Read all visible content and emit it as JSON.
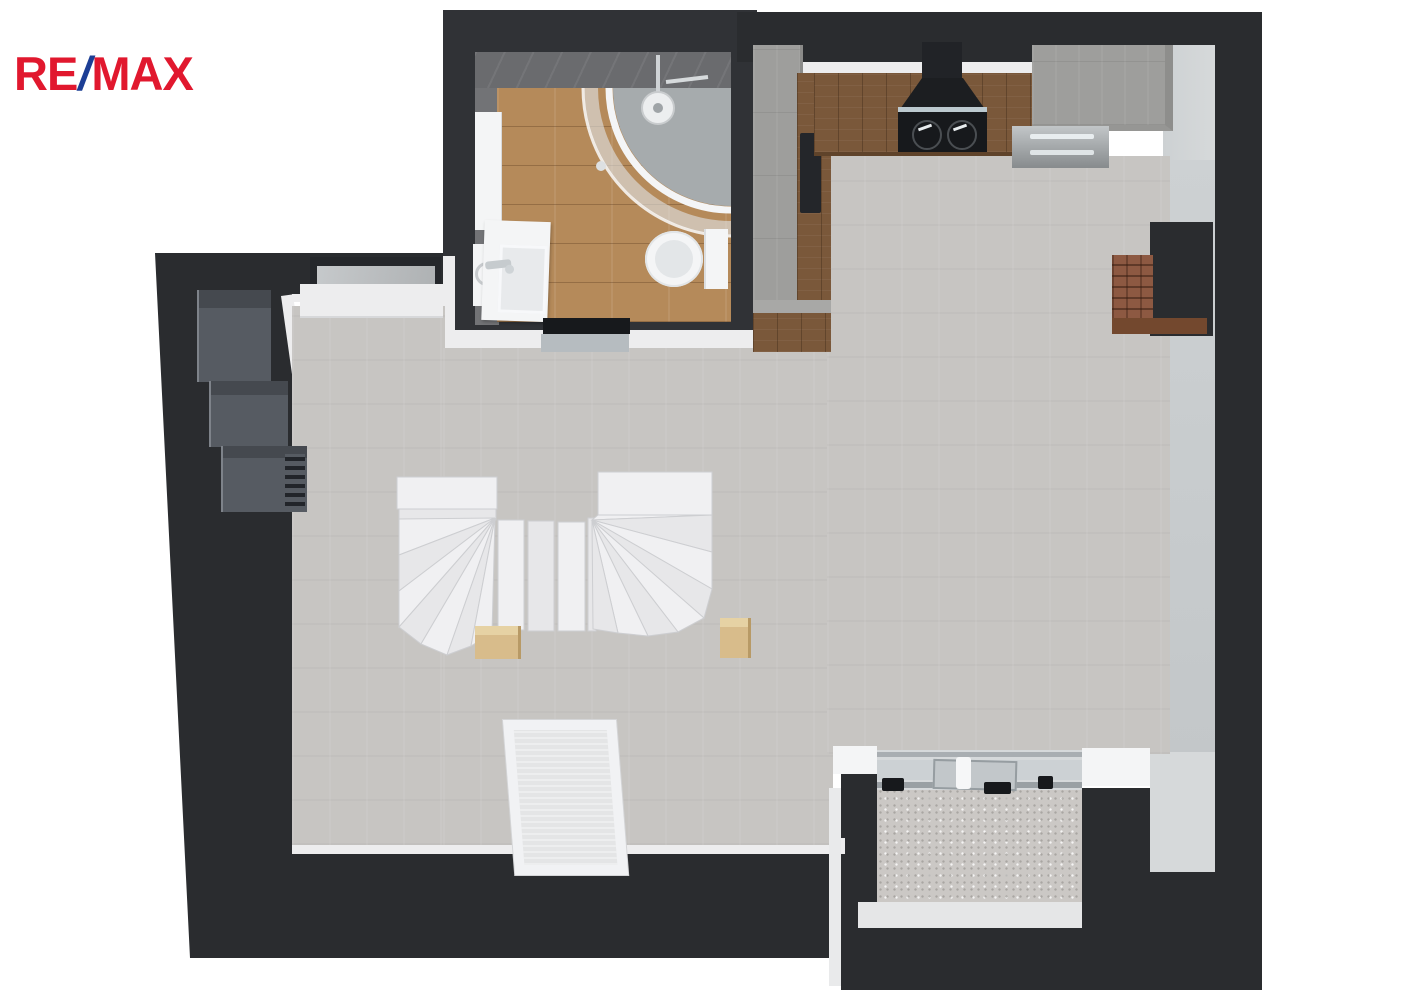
{
  "logo": {
    "re": "RE",
    "slash": "/",
    "max": "MAX"
  },
  "palette": {
    "wall": "#2a2c2f",
    "wallDeep": "#303236",
    "floor": "#c7c5c2",
    "trim": "#ededee",
    "tile": "#6a6b6e",
    "tileSide": "#727376",
    "woodFloor": "#b58a5a",
    "woodCounter": "#7a583a",
    "concrete": "#9e9e9c",
    "stairs": "#f0f0f2",
    "stairsShade": "#e7e7e9",
    "stairsLine": "#cdced1",
    "post": "#d8bc8b",
    "brick": "#8d5942",
    "brickSide": "#73482e",
    "wardrobe": "#565b62",
    "wardrobeTop": "#45494f",
    "balconyFloor": "#cbc8c5",
    "doorGray": "#d6d9db",
    "railGray": "#9aa0a4",
    "glassGray": "#ccd1d4",
    "niche": "#d6d9da",
    "innerFace": "#cdd1d3",
    "black": "#17191c",
    "white": "#f4f5f6",
    "steel": "#b9bdbf",
    "trayGray": "#a6abad",
    "logoRed": "#e1182e",
    "logoBlue": "#1c3e95"
  },
  "plan": {
    "view": "top-down-3d-floor-plan",
    "rooms": [
      "living-area",
      "bathroom",
      "kitchen",
      "balcony"
    ],
    "fixtures": [
      "corner-shower",
      "toilet",
      "vanity-sink",
      "washing-machine",
      "tall-cabinet",
      "kitchen-counter",
      "cooktop-with-hood",
      "fridge-cabinet",
      "oven-front",
      "winder-staircase",
      "stair-posts",
      "wardrobe-units",
      "wall-window",
      "roof-window-frame",
      "sliding-glass-door",
      "brick-chimney",
      "wall-niche"
    ]
  }
}
